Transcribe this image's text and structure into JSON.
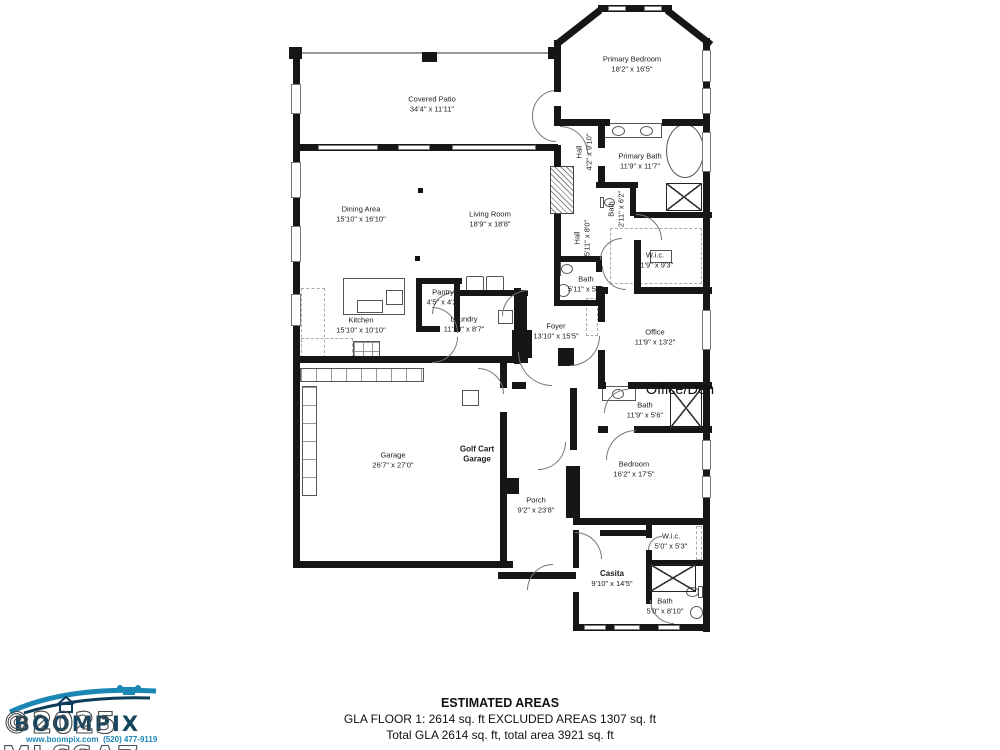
{
  "floorplan": {
    "annotation": "Office/Den",
    "rooms": [
      {
        "id": "covered-patio",
        "name": "Covered Patio",
        "dims": "34'4\" x 11'11\"",
        "x": 432,
        "y": 104
      },
      {
        "id": "primary-bedroom",
        "name": "Primary Bedroom",
        "dims": "18'2\" x 16'5\"",
        "x": 632,
        "y": 64
      },
      {
        "id": "primary-bath",
        "name": "Primary Bath",
        "dims": "11'9\" x 11'7\"",
        "x": 640,
        "y": 161
      },
      {
        "id": "hall-1",
        "name": "Hall",
        "dims": "4'2\" x 9'10\"",
        "x": 584,
        "y": 152,
        "v": true
      },
      {
        "id": "dining-area",
        "name": "Dining Area",
        "dims": "15'10\" x 16'10\"",
        "x": 361,
        "y": 214
      },
      {
        "id": "living-room",
        "name": "Living Room",
        "dims": "18'9\" x 18'8\"",
        "x": 490,
        "y": 219
      },
      {
        "id": "bath-2",
        "name": "Bath",
        "dims": "2'11\" x 6'2\"",
        "x": 616,
        "y": 209,
        "v": true
      },
      {
        "id": "hall-2",
        "name": "Hall",
        "dims": "5'11\" x 8'0\"",
        "x": 582,
        "y": 238,
        "v": true
      },
      {
        "id": "wic-1",
        "name": "W.i.c.",
        "dims": "11'9\" x 9'3\"",
        "x": 655,
        "y": 260
      },
      {
        "id": "bath-3",
        "name": "Bath",
        "dims": "5'11\" x 5'5\"",
        "x": 586,
        "y": 284
      },
      {
        "id": "kitchen",
        "name": "Kitchen",
        "dims": "15'10\" x 10'10\"",
        "x": 361,
        "y": 325
      },
      {
        "id": "pantry",
        "name": "Pantry",
        "dims": "4'5\" x 4'2\"",
        "x": 443,
        "y": 297
      },
      {
        "id": "laundry",
        "name": "Laundry",
        "dims": "11'10\" x 8'7\"",
        "x": 464,
        "y": 324
      },
      {
        "id": "foyer",
        "name": "Foyer",
        "dims": "13'10\" x 15'5\"",
        "x": 556,
        "y": 331
      },
      {
        "id": "office",
        "name": "Office",
        "dims": "11'9\" x 13'2\"",
        "x": 655,
        "y": 337
      },
      {
        "id": "bath-4",
        "name": "Bath",
        "dims": "11'9\" x 5'6\"",
        "x": 645,
        "y": 410
      },
      {
        "id": "garage",
        "name": "Garage",
        "dims": "26'7\" x 27'0\"",
        "x": 393,
        "y": 460
      },
      {
        "id": "golf-cart-garage",
        "name": "Golf Cart\nGarage",
        "dims": "",
        "x": 477,
        "y": 455,
        "b": true
      },
      {
        "id": "porch",
        "name": "Porch",
        "dims": "9'2\" x 23'8\"",
        "x": 536,
        "y": 505
      },
      {
        "id": "bedroom",
        "name": "Bedroom",
        "dims": "16'2\" x 17'5\"",
        "x": 634,
        "y": 469
      },
      {
        "id": "wic-2",
        "name": "W.i.c.",
        "dims": "5'0\" x 5'3\"",
        "x": 671,
        "y": 541
      },
      {
        "id": "casita",
        "name": "Casita",
        "dims": "9'10\" x 14'5\"",
        "x": 612,
        "y": 579,
        "b": true
      },
      {
        "id": "bath-5",
        "name": "Bath",
        "dims": "5'0\" x 8'10\"",
        "x": 665,
        "y": 606
      }
    ]
  },
  "footer": {
    "title": "ESTIMATED AREAS",
    "line1": "GLA FLOOR 1: 2614 sq. ft EXCLUDED AREAS 1307 sq. ft",
    "line2": "Total GLA 2614 sq. ft, total area 3921 sq. ft",
    "disclaimer": "Sizes And Dimensions Are Approximate. Actual May Vary."
  },
  "branding": {
    "watermark": "©2025 MLSSAZ",
    "company": "BOOMPIX",
    "website": "www.boompix.com",
    "phone": "(520) 477-9119"
  }
}
